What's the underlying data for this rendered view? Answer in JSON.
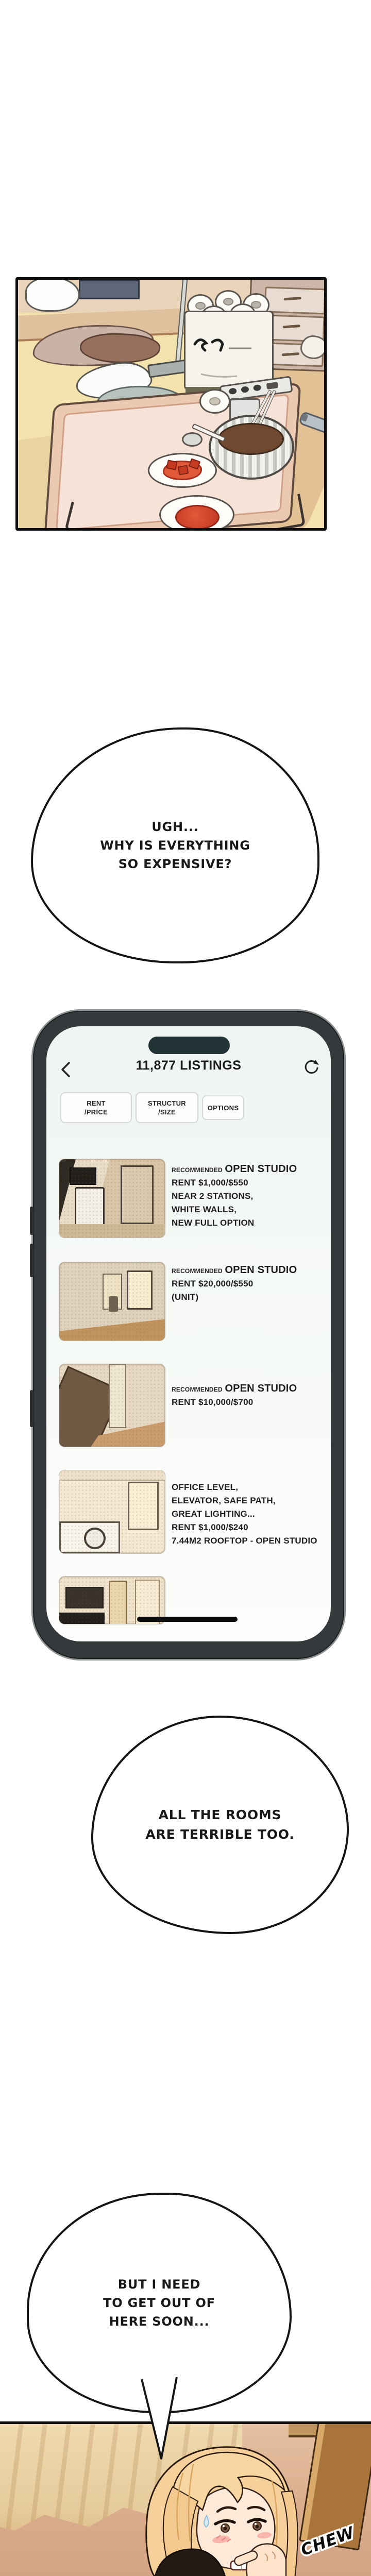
{
  "comic": {
    "bubble1": "UGH...\nWHY IS EVERYTHING\nSO EXPENSIVE?",
    "bubble2": "ALL THE ROOMS\nARE TERRIBLE TOO.",
    "bubble3": "BUT I NEED\nTO GET OUT OF\nHERE SOON...",
    "sfx_chew": "CHEW",
    "tp_pack_label": "청아"
  },
  "phone": {
    "header": {
      "title": "11,877 LISTINGS"
    },
    "filters": [
      "RENT\n/PRICE",
      "STRUCTUR\n/SIZE",
      "OPTIONS"
    ],
    "listings": [
      {
        "badge": "RECOMMENDED",
        "title": "OPEN STUDIO",
        "body": "RENT $1,000/$550\nNEAR 2 STATIONS,\nWHITE WALLS,\nNEW FULL OPTION"
      },
      {
        "badge": "RECOMMENDED",
        "title": "OPEN STUDIO",
        "body": "RENT $20,000/$550\n(UNIT)"
      },
      {
        "badge": "RECOMMENDED",
        "title": "OPEN STUDIO",
        "body": "RENT $10,000/$700"
      },
      {
        "badge": "",
        "title": "",
        "body": "OFFICE LEVEL,\nELEVATOR, SAFE PATH,\nGREAT LIGHTING...\nRENT $1,000/$240\n7.44M2 ROOFTOP - OPEN STUDIO"
      },
      {
        "badge": "",
        "title": "",
        "body": ""
      }
    ]
  },
  "colors": {
    "phone_frame": "#36393b",
    "screen_bg": "#f2f6f4",
    "dynamic_island": "#213335",
    "panel_floor": "#f3e1ae",
    "sauce_red": "#d8432c"
  }
}
